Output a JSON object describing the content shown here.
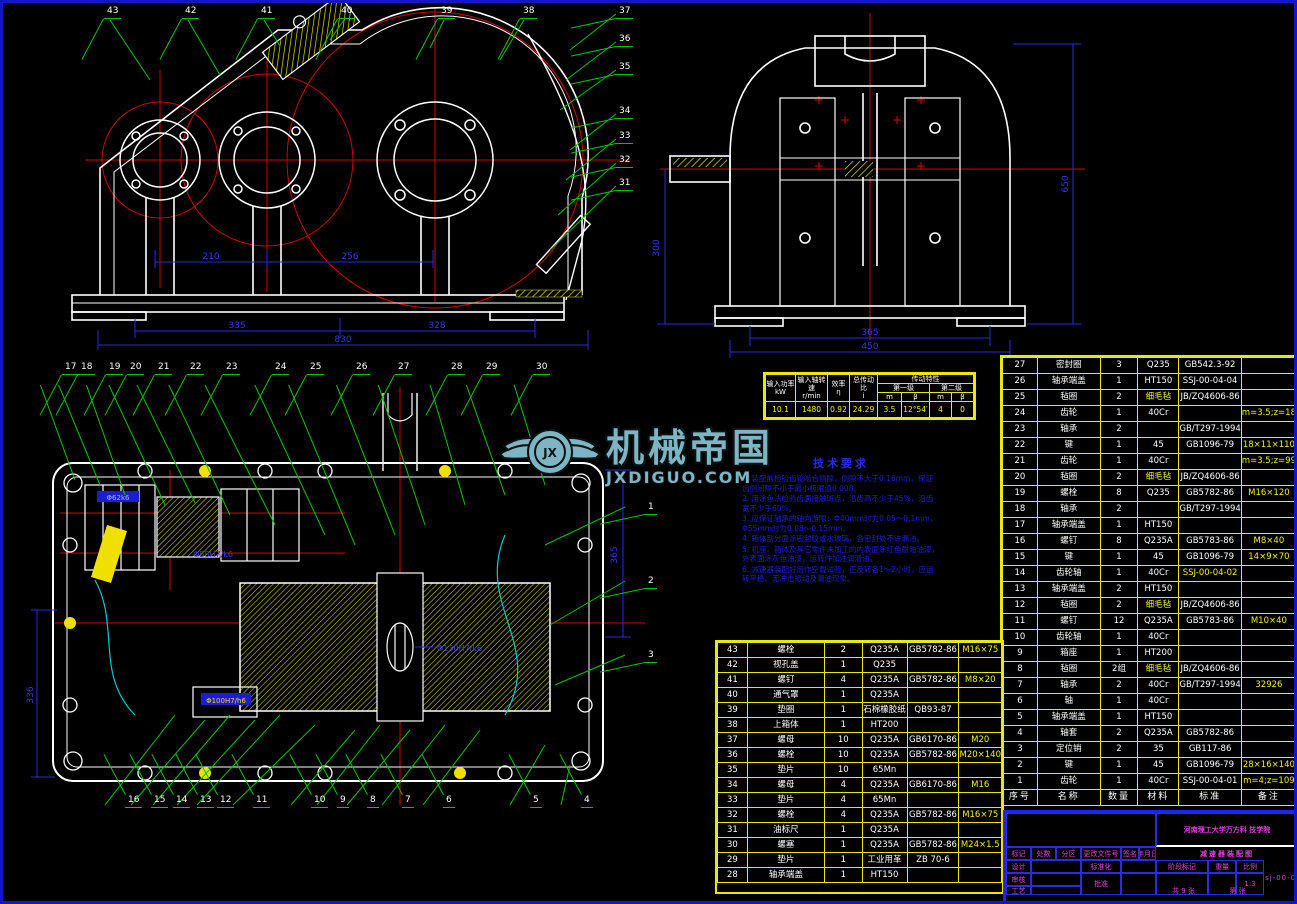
{
  "watermark": {
    "cn": "机械帝国",
    "en": "JXDIGUO.COM",
    "logo": "JX"
  },
  "tech_notes": {
    "title": "技术要求",
    "items": [
      "1. 装配前检验齿轮啮合侧隙，侧隙不大于0.16mm，保证齿侧间隙不小于最小极限值0.008。",
      "2. 用涂色法检验齿面接触斑点，沿齿高不少于45%，沿齿宽不少于60%。",
      "3. 应保证轴承的轴向游隙：Φ40mm时为0.05～0.1mm，Φ55mm时为0.08～0.15mm。",
      "4. 箱体剖分面涂密封胶或水玻璃，各密封处不许漏油。",
      "5. 机座、箱体及其它零件未加工的内表面涂红色耐油油漆，外表面涂灰色油漆，运转件加注润滑油。",
      "6. 减速器装配好后作空载试验，正反转各1～2小时，应运转平稳、无冲击振动及漏油现象。"
    ]
  },
  "spec_table": {
    "group": "传动特性",
    "headers": [
      "输入功率\nkW",
      "输入轴转速\nr/min",
      "效率\nη",
      "总传动比\ni"
    ],
    "sub1": "第一级",
    "sub2": "第二级",
    "subcols": [
      "m",
      "β",
      "m",
      "β"
    ],
    "values": [
      "10.1",
      "1480",
      "0.92",
      "24.29",
      "3.5",
      "12°54′",
      "4",
      "0"
    ]
  },
  "dims": {
    "front": {
      "a": "210",
      "b": "256",
      "c": "335",
      "d": "328",
      "e": "830"
    },
    "side": {
      "a": "365",
      "b": "450",
      "left": "300",
      "right": "650"
    },
    "plan": {
      "right": "365",
      "left": "336"
    },
    "fits": {
      "a": "Φ62k6",
      "b": "Φ58H7/k6",
      "c": "Φ130H7/k6",
      "d": "Φ100H7/h6"
    }
  },
  "balloons": {
    "front_top": [
      "43",
      "42",
      "41",
      "40",
      "39",
      "38"
    ],
    "front_right": [
      "37",
      "36",
      "35",
      "34",
      "33",
      "32",
      "31"
    ],
    "plan_top": [
      "17",
      "18",
      "19",
      "20",
      "21",
      "22",
      "23",
      "24",
      "25",
      "26",
      "27",
      "28",
      "29",
      "30"
    ],
    "plan_bottom": [
      "16",
      "15",
      "14",
      "13",
      "12",
      "11",
      "10",
      "9",
      "8",
      "7",
      "6",
      "5",
      "4"
    ],
    "plan_right": [
      "1",
      "2",
      "3"
    ]
  },
  "bom_right": {
    "header": [
      "序号",
      "名称",
      "数量",
      "材料",
      "标准",
      "备注"
    ],
    "rows": [
      [
        "27",
        "密封圈",
        "3",
        "Q235",
        "GB542.3-92",
        ""
      ],
      [
        "26",
        "轴承端盖",
        "1",
        "HT150",
        "SSJ-00-04-04",
        ""
      ],
      [
        "25",
        "毡圈",
        "2",
        "细毛毡",
        "JB/ZQ4606-86",
        ""
      ],
      [
        "24",
        "齿轮",
        "1",
        "40Cr",
        "",
        "m=3.5;z=18"
      ],
      [
        "23",
        "轴承",
        "2",
        "",
        "GB/T297-1994",
        ""
      ],
      [
        "22",
        "键",
        "1",
        "45",
        "GB1096-79",
        "18×11×110"
      ],
      [
        "21",
        "齿轮",
        "1",
        "40Cr",
        "",
        "m=3.5;z=99"
      ],
      [
        "20",
        "毡圈",
        "2",
        "细毛毡",
        "JB/ZQ4606-86",
        ""
      ],
      [
        "19",
        "螺栓",
        "8",
        "Q235",
        "GB5782-86",
        "M16×120"
      ],
      [
        "18",
        "轴承",
        "2",
        "",
        "GB/T297-1994",
        ""
      ],
      [
        "17",
        "轴承端盖",
        "1",
        "HT150",
        "",
        ""
      ],
      [
        "16",
        "螺钉",
        "8",
        "Q235A",
        "GB5783-86",
        "M8×40"
      ],
      [
        "15",
        "键",
        "1",
        "45",
        "GB1096-79",
        "14×9×70"
      ],
      [
        "14",
        "齿轮轴",
        "1",
        "40Cr",
        "SSJ-00-04-02",
        ""
      ],
      [
        "13",
        "轴承端盖",
        "2",
        "HT150",
        "",
        ""
      ],
      [
        "12",
        "毡圈",
        "2",
        "细毛毡",
        "JB/ZQ4606-86",
        ""
      ],
      [
        "11",
        "螺钉",
        "12",
        "Q235A",
        "GB5783-86",
        "M10×40"
      ],
      [
        "10",
        "齿轮轴",
        "1",
        "40Cr",
        "",
        ""
      ],
      [
        "9",
        "箱座",
        "1",
        "HT200",
        "",
        ""
      ],
      [
        "8",
        "毡圈",
        "2组",
        "细毛毡",
        "JB/ZQ4606-86",
        ""
      ],
      [
        "7",
        "轴承",
        "2",
        "40Cr",
        "GB/T297-1994",
        "32926"
      ],
      [
        "6",
        "轴",
        "1",
        "40Cr",
        "",
        ""
      ],
      [
        "5",
        "轴承端盖",
        "1",
        "HT150",
        "",
        ""
      ],
      [
        "4",
        "轴套",
        "2",
        "Q235A",
        "GB5782-86",
        ""
      ],
      [
        "3",
        "定位销",
        "2",
        "35",
        "GB117-86",
        ""
      ],
      [
        "2",
        "键",
        "1",
        "45",
        "GB1096-79",
        "28×16×140"
      ],
      [
        "1",
        "齿轮",
        "1",
        "40Cr",
        "SSJ-00-04-01",
        "m=4;z=109"
      ]
    ]
  },
  "bom_left": {
    "rows": [
      [
        "43",
        "螺栓",
        "2",
        "Q235A",
        "GB5782-86",
        "M16×75"
      ],
      [
        "42",
        "视孔盖",
        "1",
        "Q235",
        "",
        ""
      ],
      [
        "41",
        "螺钉",
        "4",
        "Q235A",
        "GB5782-86",
        "M8×20"
      ],
      [
        "40",
        "通气罩",
        "1",
        "Q235A",
        "",
        ""
      ],
      [
        "39",
        "垫圈",
        "1",
        "石棉橡胶纸",
        "QB93-87",
        ""
      ],
      [
        "38",
        "上箱体",
        "1",
        "HT200",
        "",
        ""
      ],
      [
        "37",
        "螺母",
        "10",
        "Q235A",
        "GB6170-86",
        "M20"
      ],
      [
        "36",
        "螺栓",
        "10",
        "Q235A",
        "GB5782-86",
        "M20×140"
      ],
      [
        "35",
        "垫片",
        "10",
        "65Mn",
        "",
        ""
      ],
      [
        "34",
        "螺母",
        "4",
        "Q235A",
        "GB6170-86",
        "M16"
      ],
      [
        "33",
        "垫片",
        "4",
        "65Mn",
        "",
        ""
      ],
      [
        "32",
        "螺栓",
        "4",
        "Q235A",
        "GB5782-86",
        "M16×75"
      ],
      [
        "31",
        "油标尺",
        "1",
        "Q235A",
        "",
        ""
      ],
      [
        "30",
        "螺塞",
        "1",
        "Q235A",
        "GB5782-86",
        "M24×1.5"
      ],
      [
        "29",
        "垫片",
        "1",
        "工业用革",
        "ZB 70-6",
        ""
      ],
      [
        "28",
        "轴承端盖",
        "1",
        "HT150",
        "",
        ""
      ]
    ]
  },
  "title_block": {
    "school": "河南理工大学万方科\n技学院",
    "drawing_title": "减速器装配图",
    "drawing_no": "ssj-00-04",
    "scale": "1:3",
    "labels": {
      "mark": "标记",
      "count": "处数",
      "zone": "分区",
      "doc": "更改文件号",
      "sign": "签名",
      "date": "年月日",
      "design": "设计",
      "check": "审核",
      "process": "工艺",
      "standard": "标准化",
      "approve": "批准",
      "stage": "阶段标记",
      "weight": "重量",
      "ratio": "比例",
      "sheets": "共 9 张",
      "sheet": "第 张"
    }
  }
}
